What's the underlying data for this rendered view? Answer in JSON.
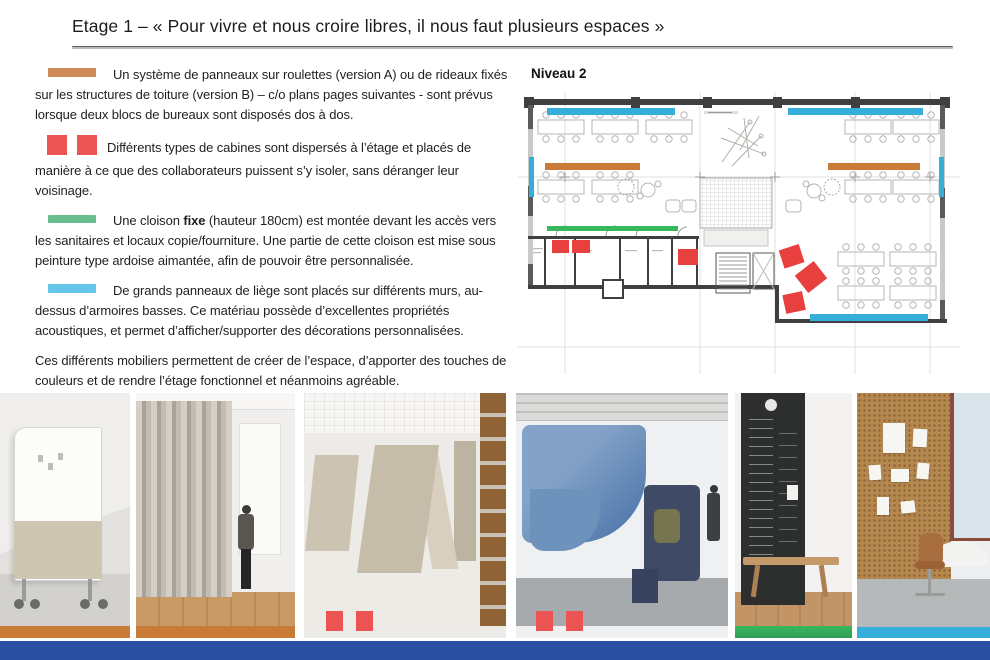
{
  "title": "Etage 1 – « Pour vivre et nous croire libres, il nous faut plusieurs espaces »",
  "colors": {
    "orange": "#CE8B57",
    "orange_deep": "#C97C38",
    "red": "#EC5353",
    "green": "#68BE8D",
    "green_deep": "#39B75C",
    "blue": "#66C6E9",
    "plan_blue": "#35AEDC",
    "plan_red": "#E8403E",
    "footer_blue": "#2A4FA2"
  },
  "paragraphs": [
    {
      "marker": "orange-bar",
      "runs": [
        {
          "t": "Un système de panneaux sur roulettes (version A) ou de rideaux fixés sur les structures de toiture (version B) – c/o plans pages suivantes - sont prévus lorsque deux blocs de bureaux sont disposés dos à dos."
        }
      ]
    },
    {
      "marker": "red-squares",
      "runs": [
        {
          "t": "Différents types de cabines sont dispersés à l’étage et placés de manière à ce que des collaborateurs puissent s’y isoler, sans déranger leur voisinage."
        }
      ]
    },
    {
      "marker": "green-bar",
      "runs": [
        {
          "t": "Une cloison "
        },
        {
          "t": "fixe",
          "b": true
        },
        {
          "t": " (hauteur 180cm) est montée devant les accès vers les sanitaires et locaux copie/fourniture.  Une partie de cette cloison est mise sous peinture type ardoise aimantée, afin de pouvoir être personnalisée."
        }
      ]
    },
    {
      "marker": "blue-bar",
      "runs": [
        {
          "t": "De grands panneaux de liège sont placés sur différents murs, au-dessus d’armoires basses.  Ce matériau possède d’excellentes propriétés acoustiques, et permet d’afficher/supporter des décorations personnalisées."
        }
      ]
    },
    {
      "marker": null,
      "runs": [
        {
          "t": "Ces différents mobiliers permettent de créer de l’espace, d’apporter des touches de couleurs et de rendre l’étage fonctionnel et néanmoins agréable."
        }
      ]
    }
  ],
  "plan": {
    "label": "Niveau 2"
  }
}
